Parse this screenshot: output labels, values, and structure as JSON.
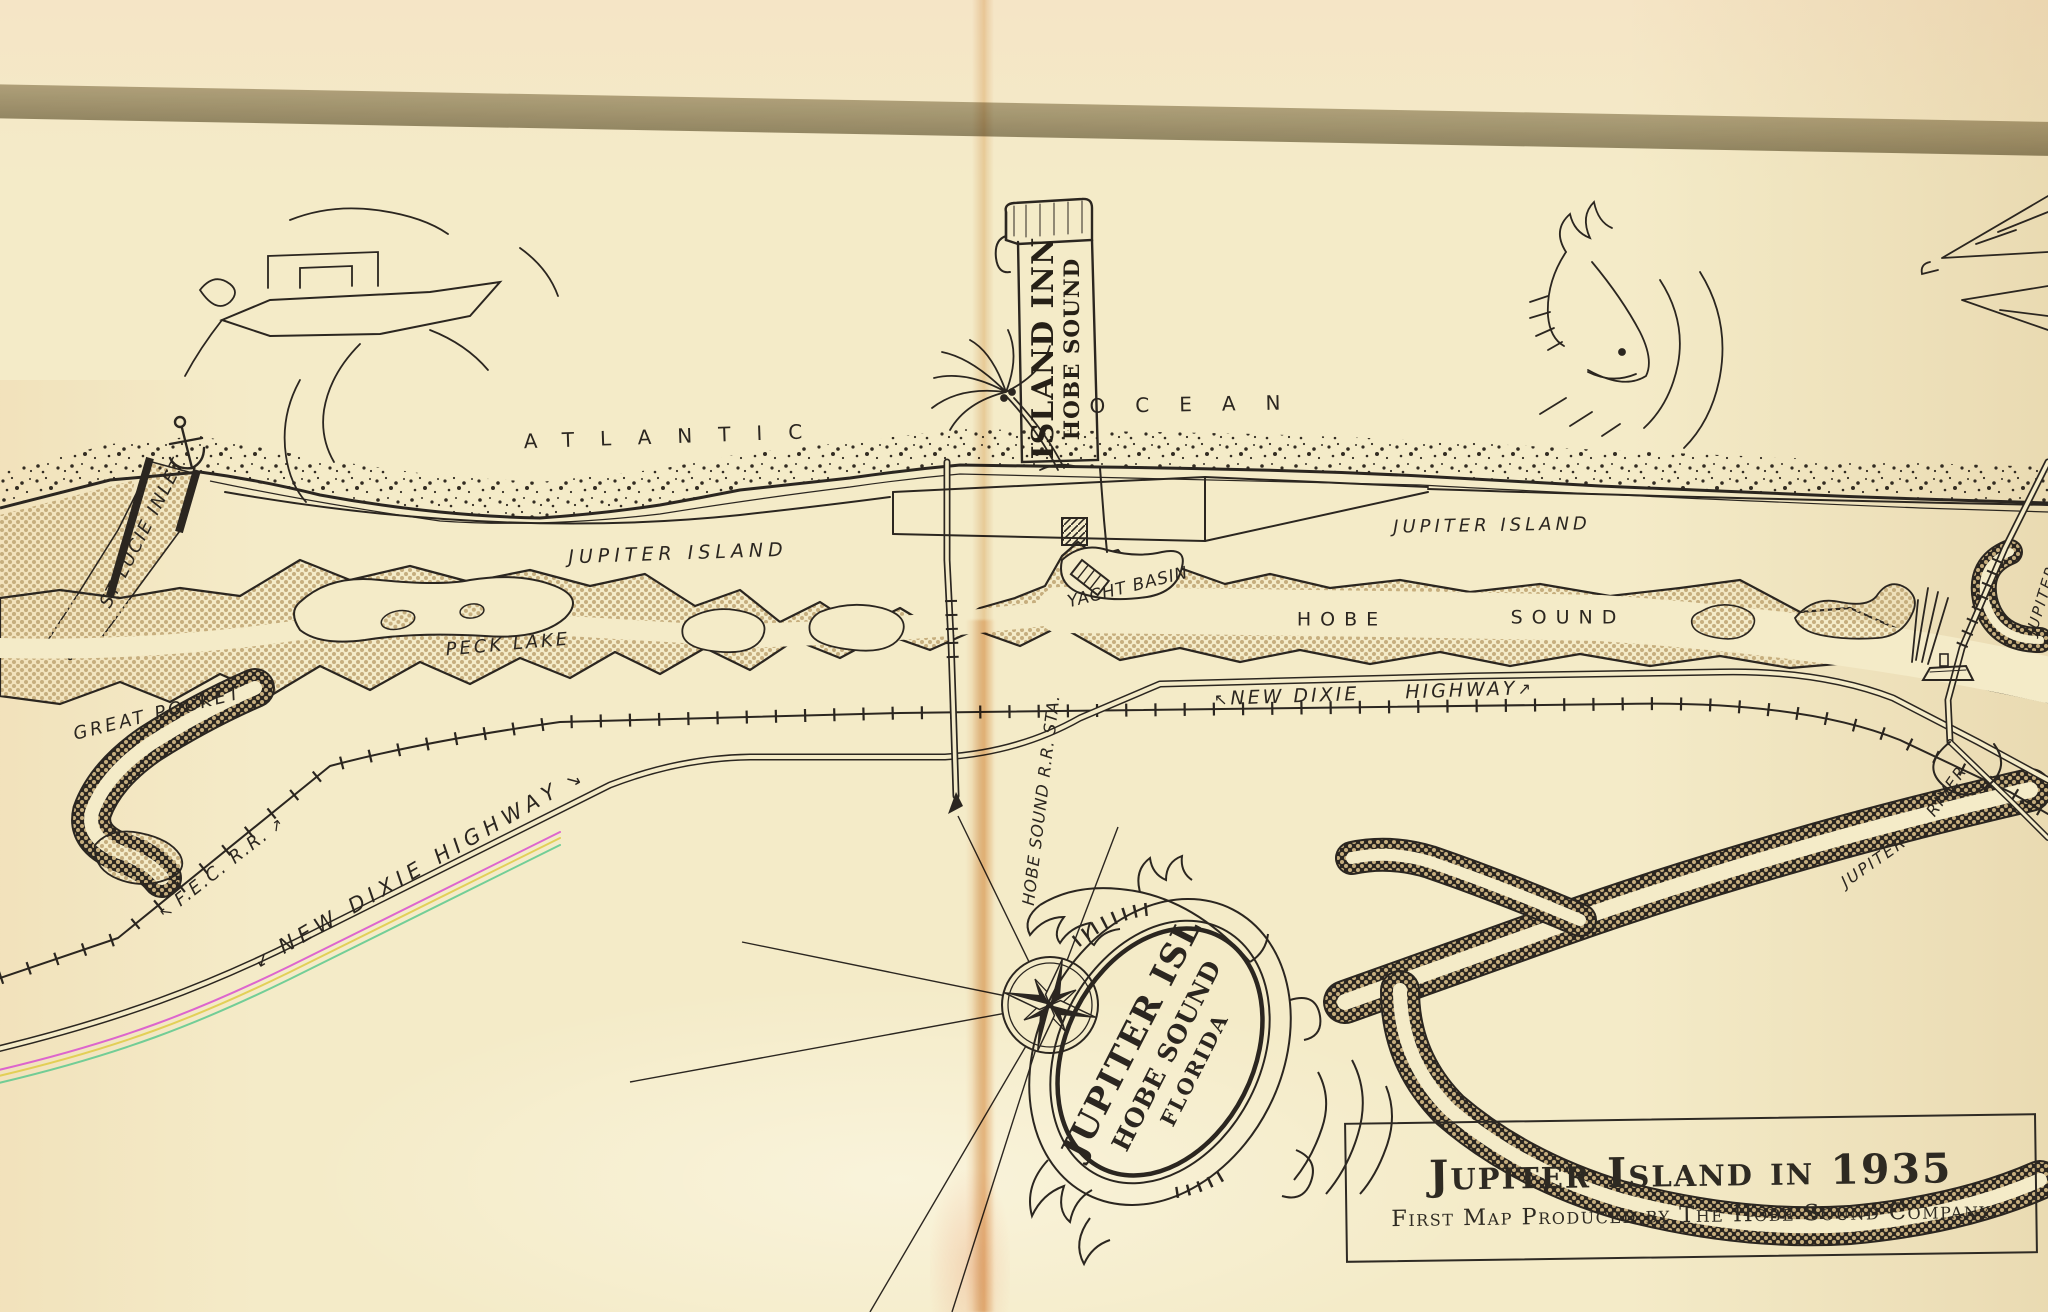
{
  "map": {
    "ocean_labels": {
      "atlantic": "ATLANTIC",
      "ocean": "OCEAN"
    },
    "island_labels": {
      "jupiter_island_west": "JUPITER ISLAND",
      "jupiter_island_east": "JUPITER ISLAND"
    },
    "water_labels": {
      "st_lucie_inlet": "ST LUCIE INLET",
      "great_pocket": "GREAT POCKET",
      "peck_lake": "PECK LAKE",
      "yacht_basin": "YACHT BASIN",
      "hobe": "HOBE",
      "sound": "SOUND",
      "jupiter_river_word1": "JUPITER",
      "jupiter_river_word2": "RIVER",
      "jupiter_edge_partial": "JUPITER"
    },
    "route_labels": {
      "new_dixie_highway_diagonal": "NEW DIXIE HIGHWAY",
      "new_dixie": "NEW DIXIE",
      "highway": "HIGHWAY",
      "fec_rr": "F.E.C. R.R.",
      "rr_station": "HOBE SOUND R.R. STA."
    },
    "arrows": {
      "up_left": "↖",
      "up_right": "↗",
      "down_left": "↙",
      "down_right": "↘"
    },
    "banner": {
      "line1": "ISLAND INN",
      "line2": "HOBE SOUND"
    },
    "emblem": {
      "line1": "JUPITER ISL",
      "line2": "HOBE SOUND",
      "line3": "FLORIDA"
    },
    "title_box": {
      "title": "Jupiter Island in 1935",
      "subtitle": "First Map Produced by The Hobe Sound Company"
    }
  },
  "colors": {
    "paper": "#f4ebc8",
    "ink": "#2b2620",
    "halftone_tan": "#c3ab7c",
    "gray_band": "#a9a28c",
    "fold": "#dfa96e",
    "rainbow": [
      "#d94fd0",
      "#e0cc45",
      "#5cc98f"
    ]
  }
}
